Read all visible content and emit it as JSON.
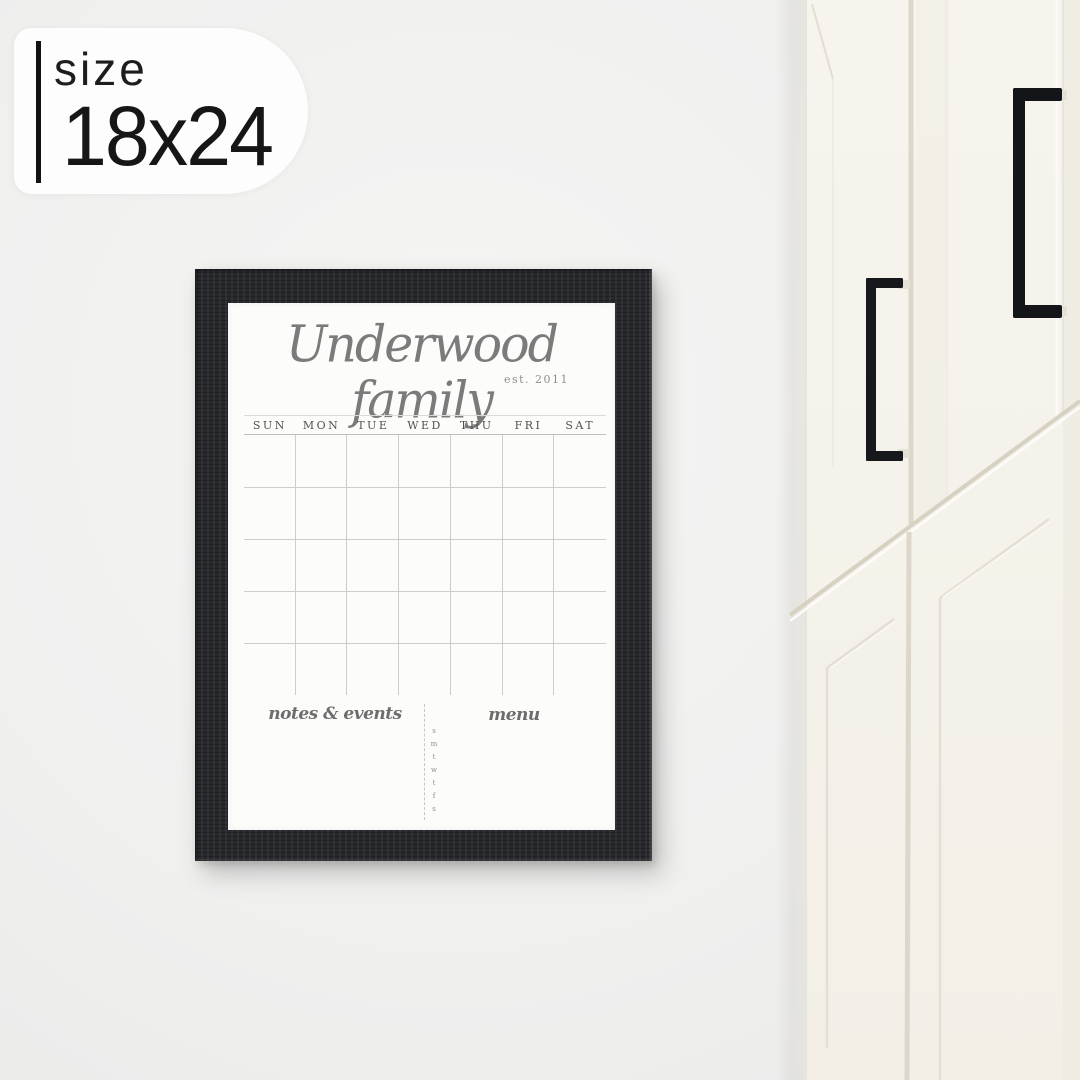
{
  "size_badge": {
    "label": "size",
    "value": "18x24"
  },
  "calendar_board": {
    "title": "Underwood family",
    "established": "est. 2011",
    "day_headers": [
      "SUN",
      "MON",
      "TUE",
      "WED",
      "THU",
      "FRI",
      "SAT"
    ],
    "grid": {
      "rows": 5,
      "columns": 7
    },
    "notes_label": "notes & events",
    "menu_label": "menu",
    "mini_week_letters": [
      "s",
      "m",
      "t",
      "w",
      "t",
      "f",
      "s"
    ]
  },
  "scene": {
    "frame_style": "black-wood-frame",
    "right_side": "white-shaker-cabinets",
    "handles": [
      "left-door-handle",
      "right-door-handle"
    ]
  },
  "colors": {
    "wall": "#f0f0ef",
    "badge_bg": "#fdfdfd",
    "badge_text": "#161616",
    "frame": "#27282c",
    "board": "#fcfcfa",
    "title_text": "#7b7b7b",
    "grid_line": "#cdcdcb",
    "day_text": "#525252",
    "script_text": "#6d6d6d",
    "cabinet": "#f5f2eb",
    "cabinet_line": "#ddd8cb",
    "handle": "#17181b"
  }
}
